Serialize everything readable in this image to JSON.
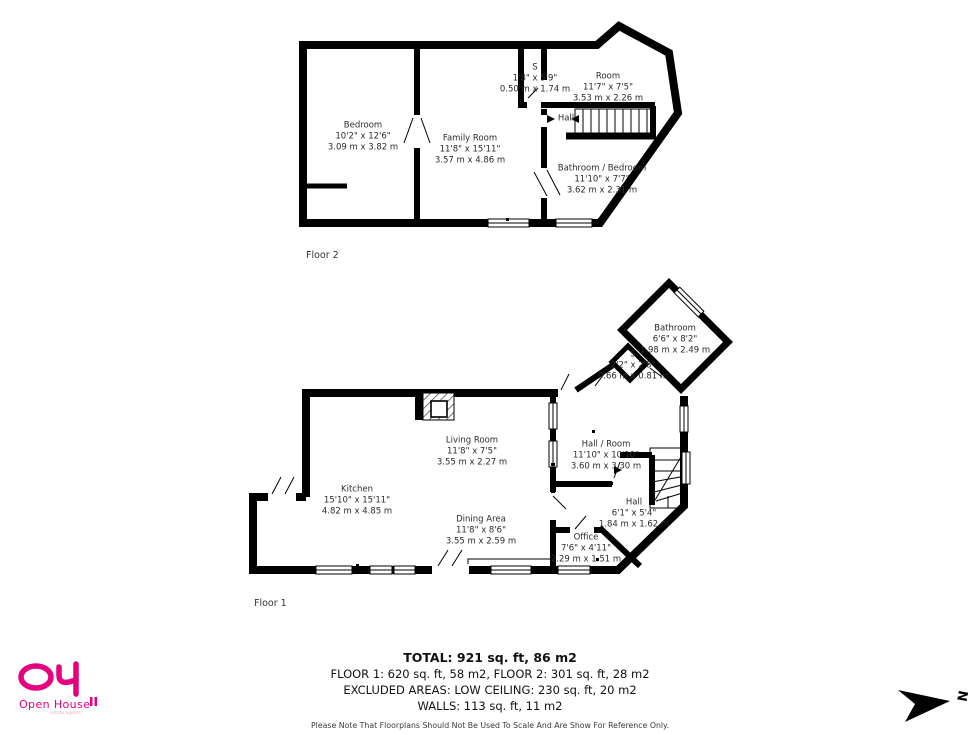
{
  "page": {
    "background": "#ffffff",
    "wall_color": "#000000",
    "accent_pink": "#e6007e"
  },
  "floor2": {
    "label": "Floor 2",
    "rooms": {
      "bedroom": {
        "name": "Bedroom",
        "ft": "10'2\" x 12'6\"",
        "m": "3.09 m x 3.82 m"
      },
      "family_room": {
        "name": "Family Room",
        "ft": "11'8\" x 15'11\"",
        "m": "3.57 m x 4.86 m"
      },
      "s_closet": {
        "name": "S",
        "ft": "1'8\" x 5'9\"",
        "m": "0.50 m x 1.74 m"
      },
      "room": {
        "name": "Room",
        "ft": "11'7\" x 7'5\"",
        "m": "3.53 m x 2.26 m"
      },
      "hall": {
        "name": "Hall"
      },
      "bathroom_bedroom": {
        "name": "Bathroom / Bedroom",
        "ft": "11'10\" x 7'7\"",
        "m": "3.62 m x 2.31 m"
      }
    }
  },
  "floor1": {
    "label": "Floor 1",
    "rooms": {
      "kitchen": {
        "name": "Kitchen",
        "ft": "15'10\" x 15'11\"",
        "m": "4.82 m x 4.85 m"
      },
      "living_room": {
        "name": "Living Room",
        "ft": "11'8\" x 7'5\"",
        "m": "3.55 m x 2.27 m"
      },
      "dining_area": {
        "name": "Dining Area",
        "ft": "11'8\" x 8'6\"",
        "m": "3.55 m x 2.59 m"
      },
      "hall_room": {
        "name": "Hall / Room",
        "ft": "11'10\" x 10'10\"",
        "m": "3.60 m x 3.30 m"
      },
      "hall": {
        "name": "Hall",
        "ft": "6'1\" x 5'4\"",
        "m": "1.84 m x 1.62 m"
      },
      "office": {
        "name": "Office",
        "ft": "7'6\" x 4'11\"",
        "m": "2.29 m x 1.51 m"
      },
      "bathroom": {
        "name": "Bathroom",
        "ft": "6'6\" x 8'2\"",
        "m": "1.98 m x 2.49 m"
      },
      "s_closet": {
        "name": "S",
        "ft": "2'2\" x 2'8\"",
        "m": "0.66 m x 0.81 m"
      }
    }
  },
  "summary": {
    "total": "TOTAL: 921 sq. ft, 86 m2",
    "floors": "FLOOR 1: 620 sq. ft, 58 m2, FLOOR 2: 301 sq. ft, 28 m2",
    "excluded": "EXCLUDED AREAS: LOW CEILING: 230 sq. ft, 20 m2",
    "walls": "WALLS: 113 sq. ft, 11 m2",
    "disclaimer": "Please Note That Floorplans Should Not Be Used To Scale And Are Show For Reference Only."
  },
  "logo": {
    "brand": "Open House",
    "tagline": "estate agents"
  },
  "compass": {
    "letter": "N"
  }
}
